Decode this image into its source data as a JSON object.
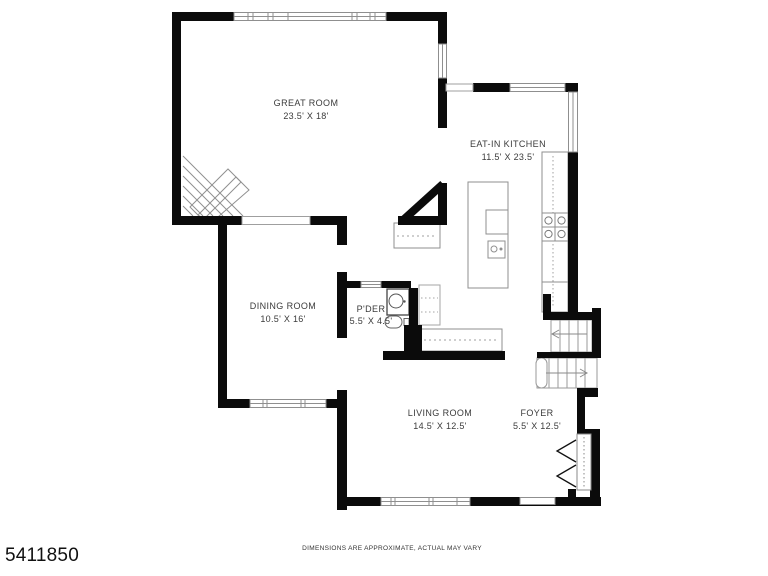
{
  "floorplan": {
    "rooms": [
      {
        "id": "great-room",
        "name": "GREAT ROOM",
        "dims": "23.5' X 18'"
      },
      {
        "id": "eat-in-kitchen",
        "name": "EAT-IN KITCHEN",
        "dims": "11.5' X 23.5'"
      },
      {
        "id": "dining-room",
        "name": "DINING ROOM",
        "dims": "10.5' X 16'"
      },
      {
        "id": "powder-room",
        "name": "P'DER",
        "dims": "5.5' X 4.5'"
      },
      {
        "id": "living-room",
        "name": "LIVING ROOM",
        "dims": "14.5' X 12.5'"
      },
      {
        "id": "foyer",
        "name": "FOYER",
        "dims": "5.5' X 12.5'"
      }
    ],
    "listing_id": "5411850",
    "disclaimer": "DIMENSIONS ARE APPROXIMATE, ACTUAL MAY VARY",
    "colors": {
      "wall": "#0b0b0b",
      "line": "#8f8f8f",
      "background": "#ffffff"
    }
  }
}
